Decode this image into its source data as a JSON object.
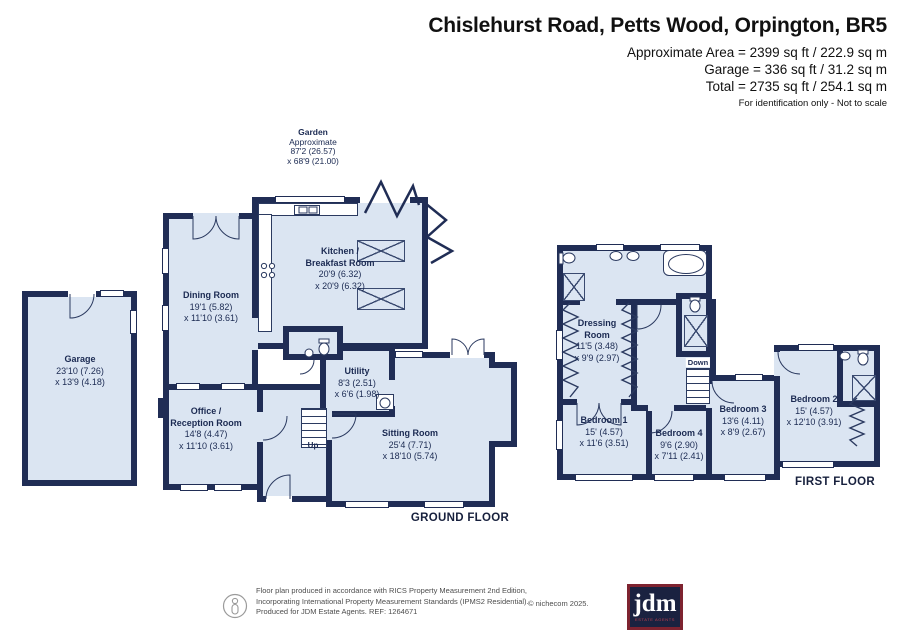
{
  "header": {
    "title": "Chislehurst Road, Petts Wood, Orpington, BR5",
    "area_line1": "Approximate Area = 2399 sq ft / 222.9 sq m",
    "area_line2": "Garage = 336 sq ft / 31.2 sq m",
    "area_line3": "Total = 2735 sq ft / 254.1 sq m",
    "disclaimer": "For identification only - Not to scale"
  },
  "garden": {
    "name": "Garden",
    "line2": "Approximate",
    "dim1": "87'2 (26.57)",
    "dim2": "x 68'9 (21.00)"
  },
  "ground": {
    "floor_label": "GROUND FLOOR",
    "up_label": "Up",
    "garage": {
      "name": "Garage",
      "dim1": "23'10 (7.26)",
      "dim2": "x 13'9 (4.18)"
    },
    "dining": {
      "name": "Dining Room",
      "dim1": "19'1 (5.82)",
      "dim2": "x 11'10 (3.61)"
    },
    "kitchen": {
      "name1": "Kitchen /",
      "name2": "Breakfast Room",
      "dim1": "20'9 (6.32)",
      "dim2": "x 20'9 (6.32)"
    },
    "office": {
      "name1": "Office /",
      "name2": "Reception Room",
      "dim1": "14'8 (4.47)",
      "dim2": "x 11'10 (3.61)"
    },
    "utility": {
      "name": "Utility",
      "dim1": "8'3 (2.51)",
      "dim2": "x 6'6 (1.98)"
    },
    "sitting": {
      "name": "Sitting Room",
      "dim1": "25'4 (7.71)",
      "dim2": "x 18'10 (5.74)"
    }
  },
  "first": {
    "floor_label": "FIRST FLOOR",
    "down_label": "Down",
    "dressing": {
      "name1": "Dressing",
      "name2": "Room",
      "dim1": "11'5 (3.48)",
      "dim2": "x 9'9 (2.97)"
    },
    "bedroom1": {
      "name": "Bedroom 1",
      "dim1": "15' (4.57)",
      "dim2": "x 11'6 (3.51)"
    },
    "bedroom4": {
      "name": "Bedroom 4",
      "dim1": "9'6 (2.90)",
      "dim2": "x 7'11 (2.41)"
    },
    "bedroom3": {
      "name": "Bedroom 3",
      "dim1": "13'6 (4.11)",
      "dim2": "x 8'9 (2.67)"
    },
    "bedroom2": {
      "name": "Bedroom 2",
      "dim1": "15' (4.57)",
      "dim2": "x 12'10 (3.91)"
    }
  },
  "footer": {
    "line1": "Floor plan produced in accordance with RICS Property Measurement 2nd Edition,",
    "line2": "Incorporating International Property Measurement Standards (IPMS2 Residential).",
    "line3": "Produced for JDM Estate Agents.   REF: 1264671",
    "copyright": "© nichecom 2025."
  },
  "logo": {
    "text": "jdm",
    "subtext": "ESTATE AGENTS"
  },
  "icons": {
    "footer_badge": "person-in-circle"
  },
  "colors": {
    "wall": "#202d55",
    "floor_fill": "#dbe5f2",
    "label_text": "#1b2a52",
    "logo_bg": "#1a2240",
    "logo_border": "#7e2330",
    "logo_accent": "#c0404e"
  }
}
